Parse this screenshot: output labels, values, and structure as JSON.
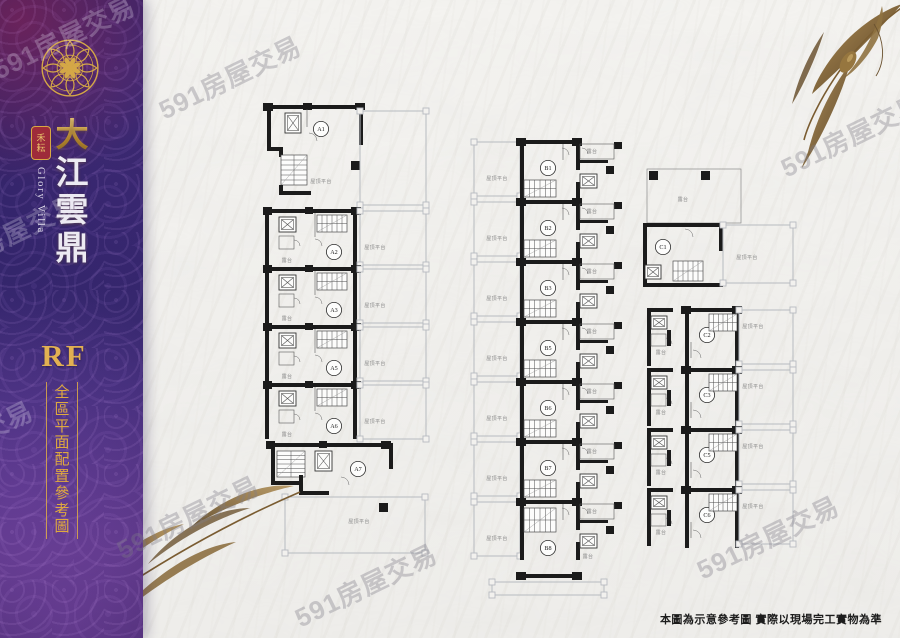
{
  "brand": {
    "seal": "禾耘",
    "title": "大江雲鼎",
    "subtitle_en": "Glory Villa",
    "floor_code": "RF",
    "caption": "全區平面配置參考圖"
  },
  "colors": {
    "gold": "#d4a747",
    "gold_deep": "#b3832f",
    "seal_red": "#9e2b3a",
    "sidebar_purple": "#3a2a72",
    "canvas": "#f2f1ee",
    "wall": "#1b1b1b",
    "thin_line": "#5a5a5a",
    "platform_line": "#b7bbc0",
    "label_gray": "#8a8a8a",
    "watermark_gray": "#9a98a0"
  },
  "watermark": {
    "text": "591房屋交易",
    "instances": [
      {
        "x": -6,
        "y": 52,
        "light": true
      },
      {
        "x": 160,
        "y": 92,
        "light": false
      },
      {
        "x": -62,
        "y": 250,
        "light": true
      },
      {
        "x": -108,
        "y": 457,
        "light": true
      },
      {
        "x": 118,
        "y": 532,
        "light": false
      },
      {
        "x": 296,
        "y": 600,
        "light": false
      },
      {
        "x": 782,
        "y": 150,
        "light": false
      },
      {
        "x": 698,
        "y": 552,
        "light": false
      }
    ]
  },
  "floorplans": {
    "platform_label": "屋頂平台",
    "terrace_label": "露台",
    "buildings": [
      {
        "id": "A",
        "units": [
          "A1",
          "A2",
          "A3",
          "A5",
          "A6",
          "A7"
        ]
      },
      {
        "id": "B",
        "units": [
          "B1",
          "B2",
          "B3",
          "B5",
          "B6",
          "B7",
          "B8"
        ]
      },
      {
        "id": "C",
        "units": [
          "C1",
          "C2",
          "C3",
          "C5",
          "C6"
        ]
      }
    ]
  },
  "disclaimer": "本圖為示意參考圖 實際以現場完工實物為準"
}
